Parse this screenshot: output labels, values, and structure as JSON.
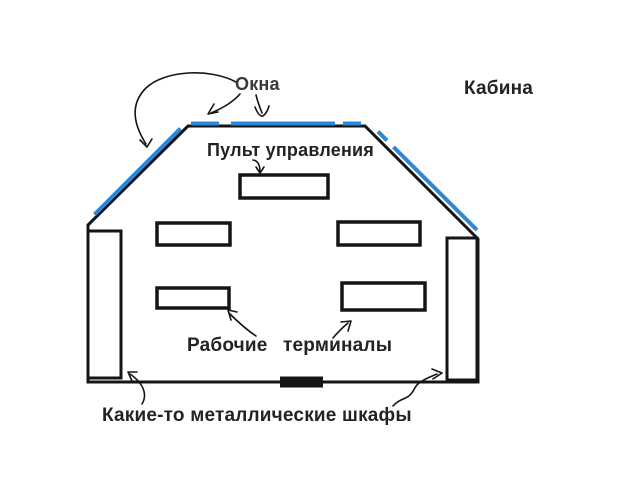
{
  "diagram": {
    "title": "Кабина",
    "labels": {
      "windows": "Окна",
      "cabin": "Кабина",
      "control_panel": "Пульт управления",
      "terminals": "Рабочие терминалы",
      "cabinets": "Какие-то металлические шкафы"
    },
    "colors": {
      "background": "#ffffff",
      "line": "#151515",
      "window_blue": "#2b87d8",
      "text": "#232323"
    }
  }
}
